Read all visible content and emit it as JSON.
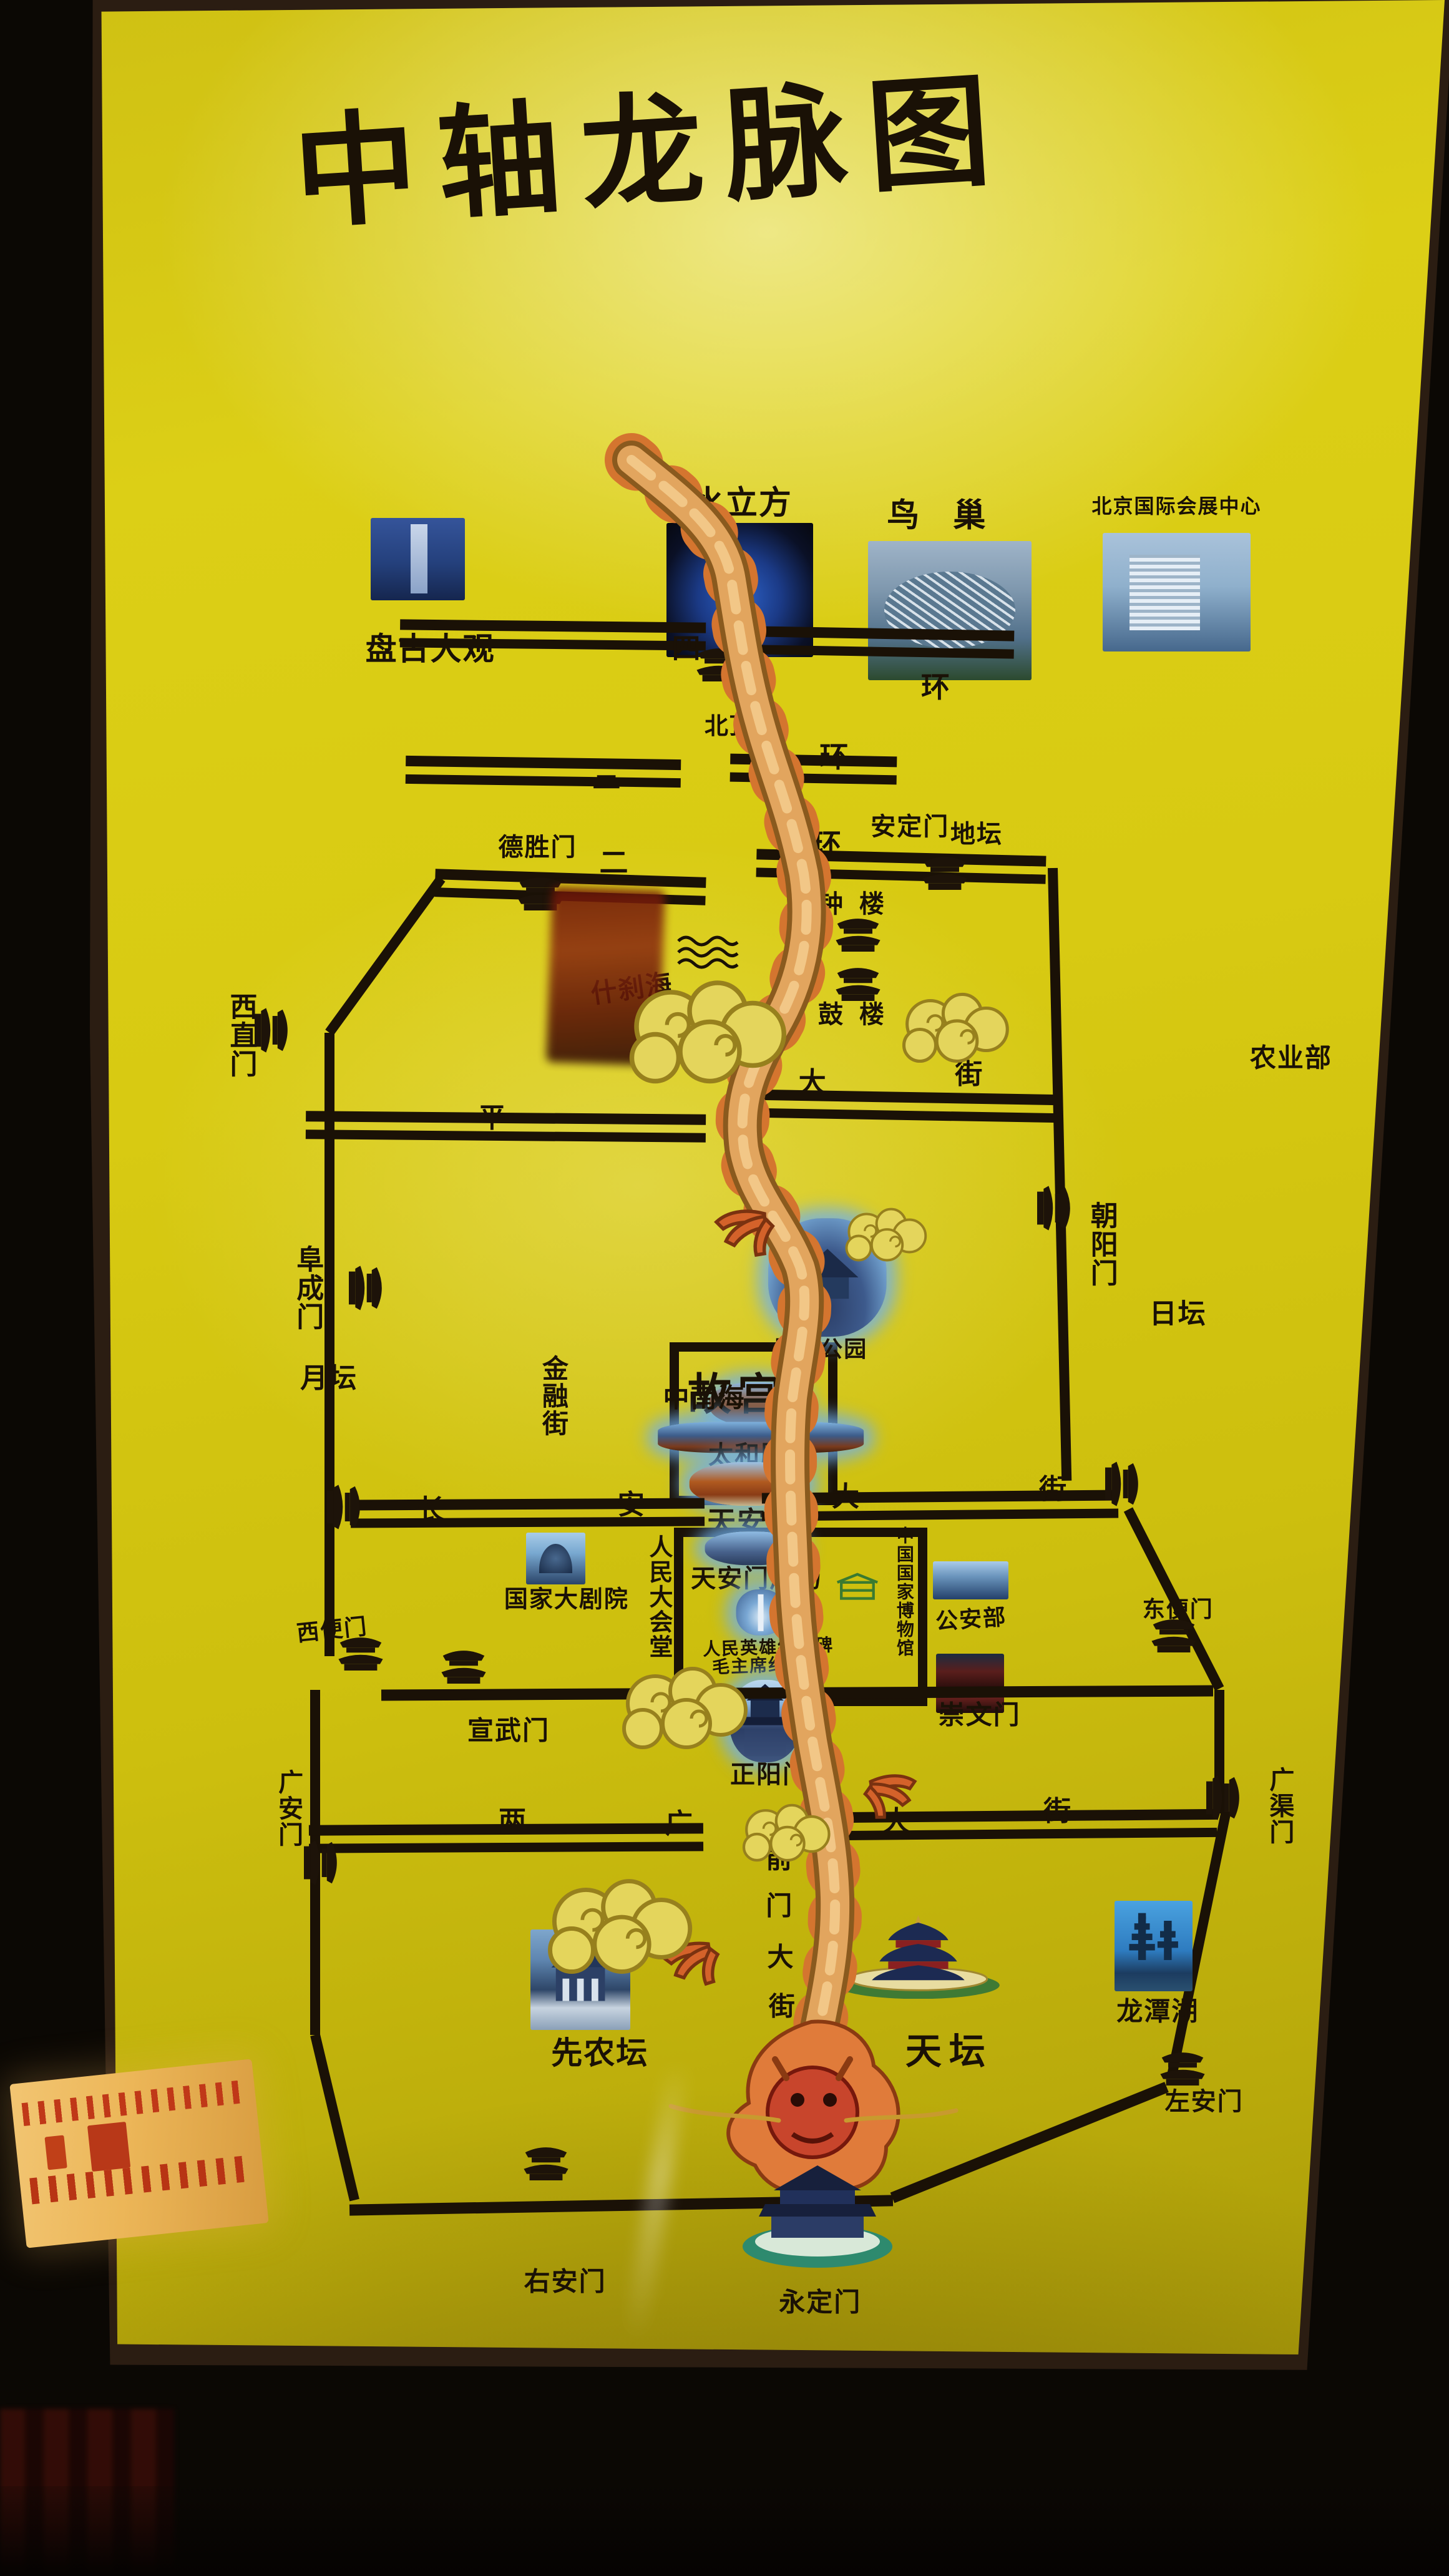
{
  "colors": {
    "sign_yellow": "#d9cb15",
    "line_black": "#1a1106",
    "dragon_body": "#e2a55e",
    "dragon_fin_orange": "#d4752f",
    "dragon_head_red": "#c8452c",
    "photo_glow_blue": "#7ab4e8"
  },
  "sign": {
    "title": "中轴龙脉图"
  },
  "north": {
    "pangu": "盘古大观",
    "water_cube": "水立方",
    "beiding": "北顶庙",
    "birds_nest": "鸟 巢",
    "exhibition": "北京国际会展中心"
  },
  "rings": {
    "r4l": "四",
    "r4r": "环",
    "r3l": "三",
    "r3r": "环",
    "r2l": "二",
    "r2r": "环"
  },
  "gates": {
    "deshengmen": "德胜门",
    "andingmen": "安定门",
    "xizhimen": "西直门",
    "fuchengmen": "阜成门",
    "chaoyangmen": "朝阳门",
    "xibianmen": "西便门",
    "dongbianmen": "东便门",
    "xuanwumen": "宣武门",
    "chongwenmen": "崇文门",
    "guanganmen": "广安门",
    "guangqumen": "广渠门",
    "youanmen": "右安门",
    "zuoanmen": "左安门",
    "yongdingmen": "永定门"
  },
  "parks": {
    "ditan": "地坛",
    "yuetan": "月坛",
    "ritan": "日坛",
    "xiannongtan": "先农坛",
    "tiantan": "天坛",
    "longtanhu": "龙潭湖"
  },
  "axis": {
    "zhonglou": "钟楼",
    "gulou": "鼓楼",
    "shichahai": "什刹海",
    "jingshan": "景山公园",
    "gugong": "故宫",
    "taihedian": "太和殿",
    "tiananmen": "天安门",
    "square": "天安门广场",
    "monument": "人民英雄纪念碑",
    "mao_hall": "毛主席纪念堂",
    "zhengyangmen": "正阳门",
    "qianmen": [
      "前",
      "门",
      "大",
      "街"
    ]
  },
  "streets": {
    "pingan": [
      "平",
      "大",
      "街"
    ],
    "changan": [
      "长",
      "安",
      "大",
      "街"
    ],
    "liangguang": [
      "两",
      "广",
      "大",
      "街"
    ]
  },
  "west": {
    "jinrongjie": "金融街",
    "zhongnanhai": "中南海",
    "ncpa": "国家大剧院",
    "great_hall": "人民大会堂"
  },
  "east": {
    "nongyebu": "农业部",
    "museum": "中国国家博物馆",
    "gonganbu": "公安部"
  }
}
